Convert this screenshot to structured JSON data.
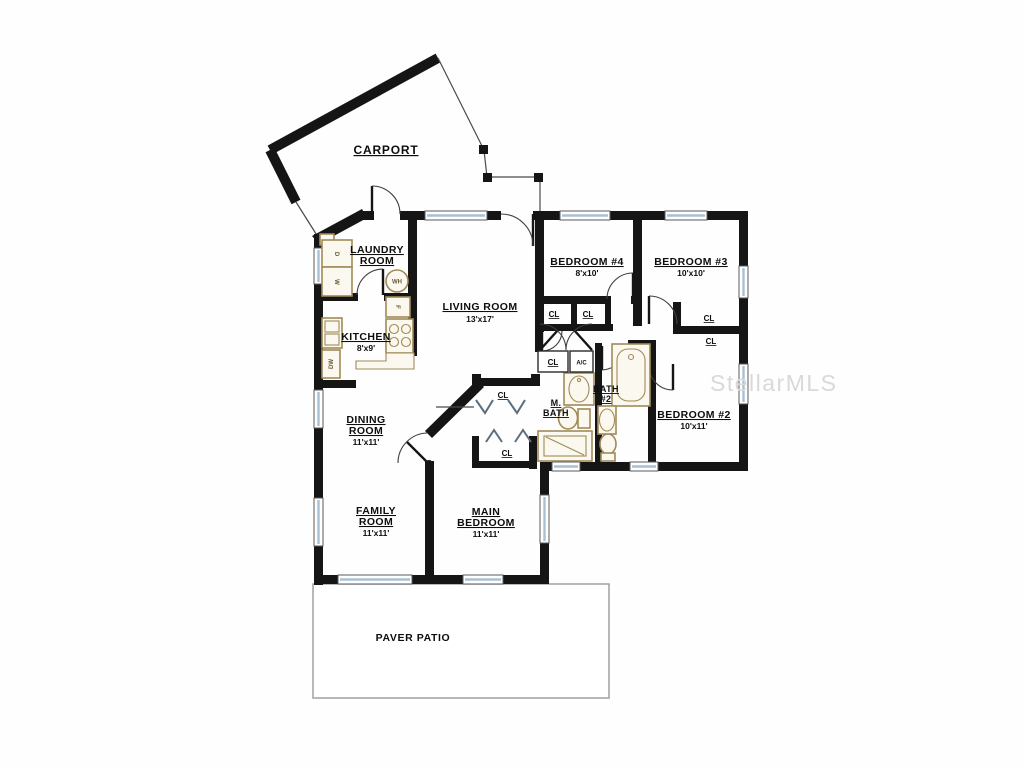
{
  "watermark": {
    "text": "StellarMLS"
  },
  "rooms": [
    {
      "id": "carport",
      "name": "CARPORT"
    },
    {
      "id": "laundry",
      "line1": "LAUNDRY",
      "line2": "ROOM"
    },
    {
      "id": "kitchen",
      "name": "KITCHEN",
      "dims": "8'x9'"
    },
    {
      "id": "living",
      "name": "LIVING ROOM",
      "dims": "13'x17'"
    },
    {
      "id": "bedroom4",
      "name": "BEDROOM #4",
      "dims": "8'x10'"
    },
    {
      "id": "bedroom3",
      "name": "BEDROOM #3",
      "dims": "10'x10'"
    },
    {
      "id": "bedroom2",
      "name": "BEDROOM #2",
      "dims": "10'x11'"
    },
    {
      "id": "bath2",
      "line1": "BATH",
      "line2": "#2"
    },
    {
      "id": "master-bath",
      "line1": "M.",
      "line2": "BATH"
    },
    {
      "id": "dining",
      "line1": "DINING",
      "line2": "ROOM",
      "dims": "11'x11'"
    },
    {
      "id": "family",
      "line1": "FAMILY",
      "line2": "ROOM",
      "dims": "11'x11'"
    },
    {
      "id": "main-bedroom",
      "line1": "MAIN",
      "line2": "BEDROOM",
      "dims": "11'x11'"
    },
    {
      "id": "patio",
      "name": "PAVER PATIO"
    }
  ],
  "labels": {
    "closet": "CL",
    "ac_closet": "A/C",
    "washer": "W",
    "dryer": "D",
    "water_heater": "WH",
    "dishwasher": "DW",
    "refrigerator": "F"
  },
  "colors": {
    "wall": "#151515",
    "window": "#a9bfd2",
    "fixture": "#a08b58",
    "watermark": "#d9d9d9"
  }
}
